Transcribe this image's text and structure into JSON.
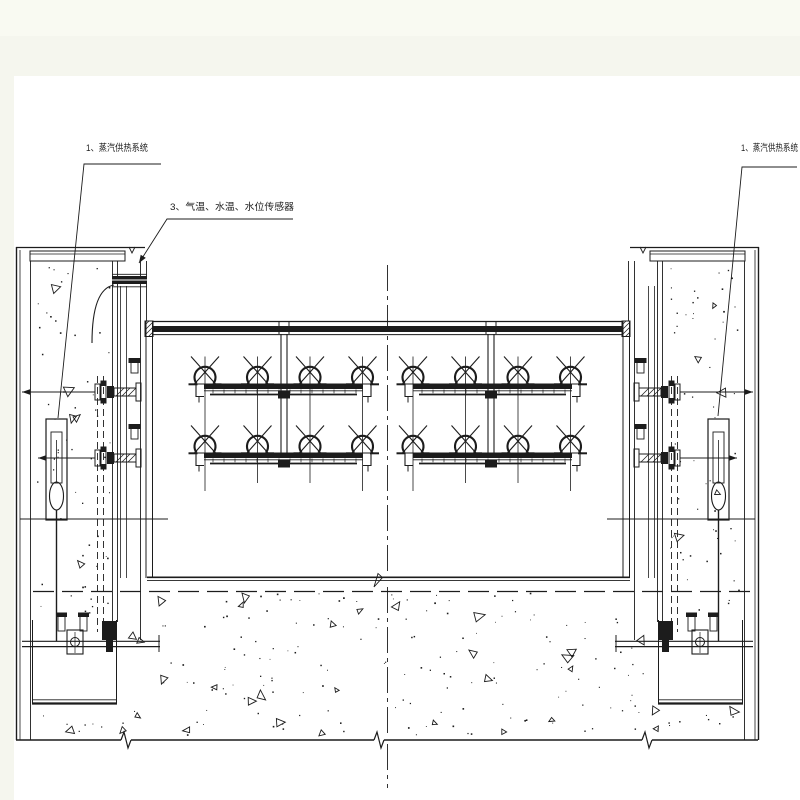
{
  "page": {
    "margin_color": "#f5f6ee",
    "top_band_color": "#f9faf2",
    "sheet_color": "#ffffff",
    "ink_color": "#1c1c1c"
  },
  "annotations": {
    "label_steam_left": "1、蒸汽供热系统",
    "label_sensors": "3、气温、水温、水位传感器",
    "label_steam_right": "1、蒸汽供热系统"
  },
  "drawing": {
    "type": "engineering-section-drawing",
    "subject": "gate heating system between two concrete piers",
    "heater_groups": 2,
    "heater_rows_per_group": 2,
    "heater_units_per_row": 4
  }
}
